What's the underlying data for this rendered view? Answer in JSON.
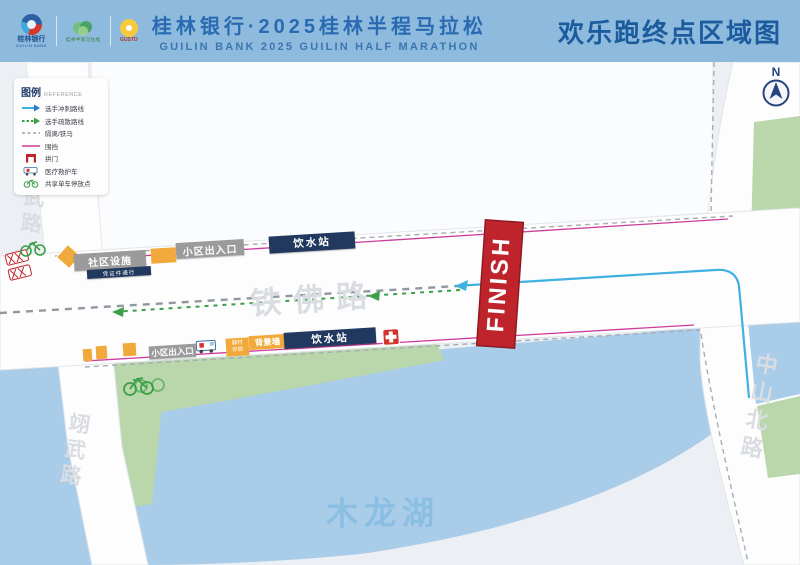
{
  "header": {
    "bank_logo": {
      "cn": "桂林银行",
      "en": "GUILIN BANK"
    },
    "marathon_logo_label": "桂林半程马拉松",
    "gusto_logo_label": "GUSTO",
    "title_cn": "桂林银行·2025桂林半程马拉松",
    "title_en": "GUILIN BANK 2025 GUILIN HALF MARATHON",
    "map_title": "欢乐跑终点区域图"
  },
  "legend": {
    "title": "图例",
    "subtitle": "REFERENCE",
    "items": [
      {
        "icon": "arrow-blue",
        "label": "选手冲刺路线"
      },
      {
        "icon": "arrow-green-dashed",
        "label": "选手疏散路线"
      },
      {
        "icon": "line-gray-dashed",
        "label": "隔离/铁马"
      },
      {
        "icon": "line-magenta",
        "label": "围挡"
      },
      {
        "icon": "finish-arch",
        "label": "拱门"
      },
      {
        "icon": "ambulance",
        "label": "医疗救护车"
      },
      {
        "icon": "bike",
        "label": "共享单车停放点"
      }
    ]
  },
  "compass": {
    "label": "N"
  },
  "map": {
    "roads": {
      "tiefo": "铁佛路",
      "yiwu_top": "翊武路",
      "yiwu_bottom": "翊武路",
      "zhongshan": "中山北路"
    },
    "lake_label": "木龙湖",
    "finish_label": "FINISH",
    "facilities": {
      "community": "社区设施",
      "community_note": "凭证件通行",
      "gate_top": "小区出入口",
      "water_top": "饮水站",
      "gate_bottom": "小区出入口",
      "equipment_line1": "器材",
      "equipment_line2": "存放",
      "backdrop": "背景墙",
      "water_bottom": "饮水站"
    }
  },
  "colors": {
    "header_bg": "#8EBBDD",
    "title_blue": "#2A6AB2",
    "map_title_navy": "#1C5C9E",
    "route_blue": "#3FB0E0",
    "route_green": "#3BA047",
    "fence_magenta": "#CD3C9C",
    "finish_red": "#BF232B",
    "water": "#A9CCE9",
    "park_green": "#BAD6AB",
    "marker_orange": "#F2A93B",
    "box_gray": "#9B9B9B",
    "box_navy": "#21395E"
  }
}
